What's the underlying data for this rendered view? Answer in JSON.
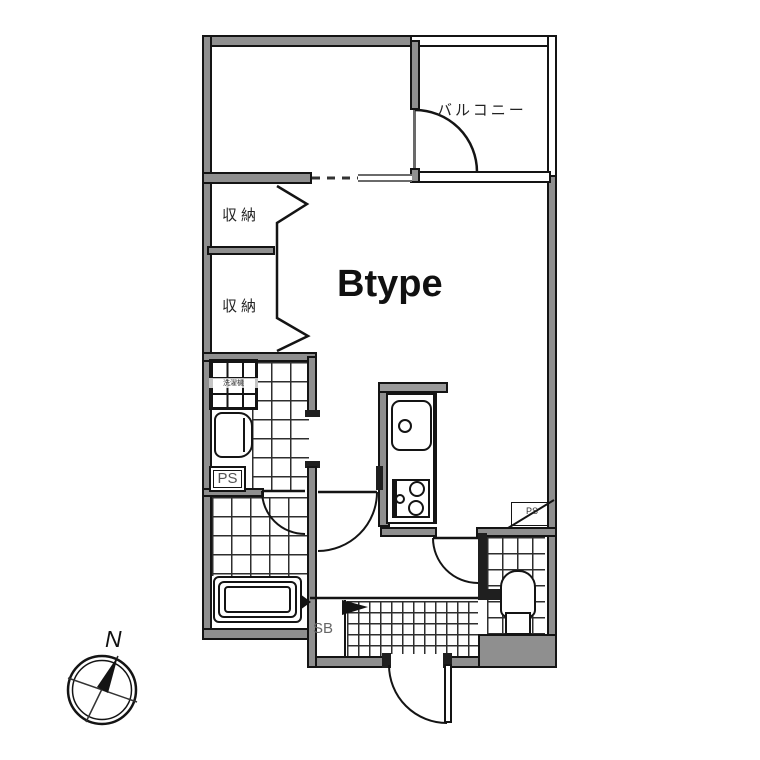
{
  "plan": {
    "type_label": "Btype",
    "balcony_label": "バルコニー",
    "closet_top_label": "収納",
    "closet_bottom_label": "収納",
    "pipe_space_left_label": "PS",
    "pipe_space_right_label": "PS",
    "shoe_box_label": "SB",
    "washer_label": "洗濯機",
    "compass_north_label": "N"
  },
  "colors": {
    "wall_fill": "#8f8f8f",
    "line": "#141414",
    "gray_text": "#555555",
    "background": "#ffffff"
  }
}
